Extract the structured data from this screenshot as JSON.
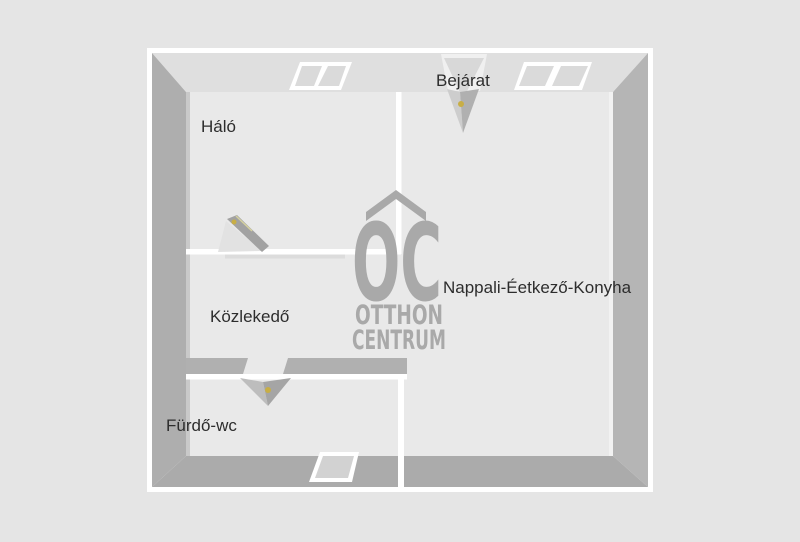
{
  "floorplan": {
    "rooms": [
      {
        "id": "halo",
        "label": "Háló"
      },
      {
        "id": "nappali",
        "label": "Nappali-Éetkező-Konyha"
      },
      {
        "id": "kozlekedo",
        "label": "Közlekedő"
      },
      {
        "id": "furdo_wc",
        "label": "Fürdő-wc"
      }
    ],
    "entrance_label": "Bejárat"
  },
  "watermark": {
    "monogram": "OC",
    "name_line1": "OTTHON",
    "name_line2": "CENTRUM"
  },
  "colors": {
    "background": "#e5e5e5",
    "floor": "#e9e9e9",
    "outline_white": "#ffffff",
    "wall_top": "#dfdfdf",
    "wall_left": "#aeaeae",
    "wall_right": "#b5b5b5",
    "wall_bottom": "#ababab",
    "interior_wall_gray": "#b0b0b0",
    "watermark_gray": "#a9a9a9",
    "label_text": "#2d2d2d",
    "door_handle": "#c8ae45"
  }
}
